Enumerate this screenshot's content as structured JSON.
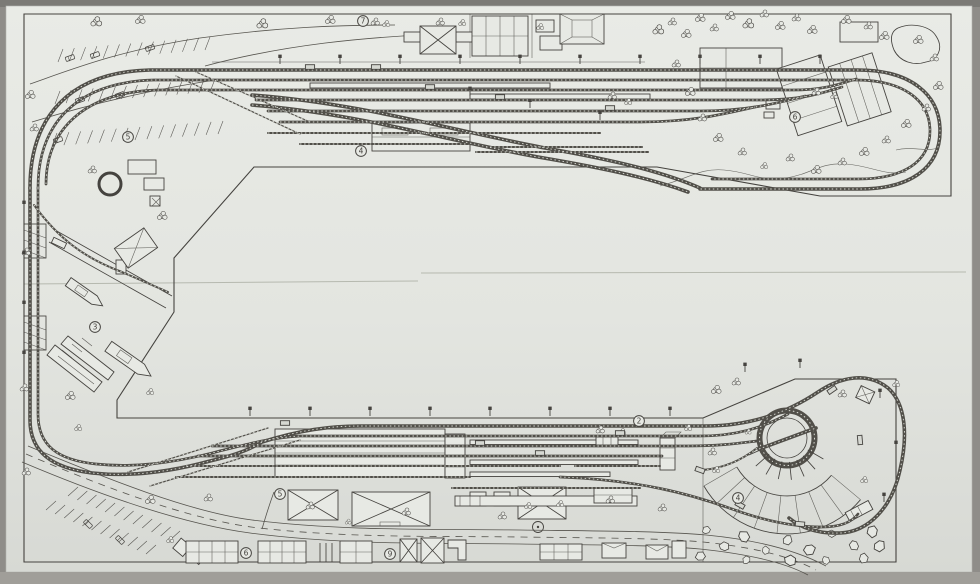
{
  "plan": {
    "markers": [
      {
        "label": "5",
        "x": 128,
        "y": 137
      },
      {
        "label": "7",
        "x": 363,
        "y": 21
      },
      {
        "label": "4",
        "x": 361,
        "y": 151
      },
      {
        "label": "6",
        "x": 795,
        "y": 117
      },
      {
        "label": "3",
        "x": 95,
        "y": 327
      },
      {
        "label": "2",
        "x": 639,
        "y": 421
      },
      {
        "label": "5",
        "x": 280,
        "y": 494
      },
      {
        "label": "4",
        "x": 738,
        "y": 498
      },
      {
        "label": "6",
        "x": 246,
        "y": 553
      },
      {
        "label": "9",
        "x": 390,
        "y": 554
      }
    ],
    "colors": {
      "photo_background": "#8f8d89",
      "paper": "#e3e5e0",
      "ink": "#45433f",
      "track": "#514f49",
      "tie": "#d9dbd4",
      "crease": "#b6b9af"
    }
  }
}
